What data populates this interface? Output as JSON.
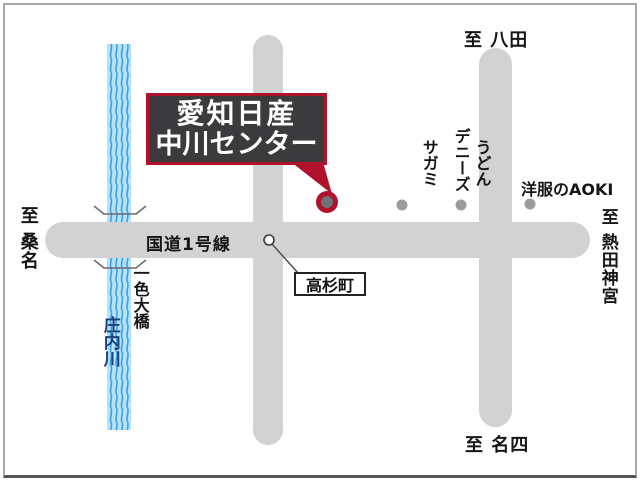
{
  "title": "愛知日産 中川センター 地図",
  "main_label": {
    "line1": "愛知日産",
    "line2": "中川センター"
  },
  "roads": {
    "route1_label": "国道1号線"
  },
  "destinations": {
    "top": "至 八田",
    "left": "至 桑名",
    "right": "至 熱田神宮",
    "bottom": "至 名四"
  },
  "intersection": {
    "label": "高杉町"
  },
  "river": {
    "name": "庄内川",
    "bridge_name": "一色大橋"
  },
  "pois": {
    "sagami": {
      "line1": "うどん",
      "line2": "サガミ"
    },
    "dennys": {
      "label": "デニーズ"
    },
    "aoki": {
      "label": "洋服のAOKI"
    }
  },
  "colors": {
    "road": "#d2d2d2",
    "accent": "#b0122c",
    "box-fill": "#3b3b3d",
    "marker-center": "#717175",
    "river-bg": "#b5e2f8",
    "river-wave": "#3da0dd",
    "poi-dot": "#9c9c9c",
    "river-text": "#1c3f7d"
  }
}
